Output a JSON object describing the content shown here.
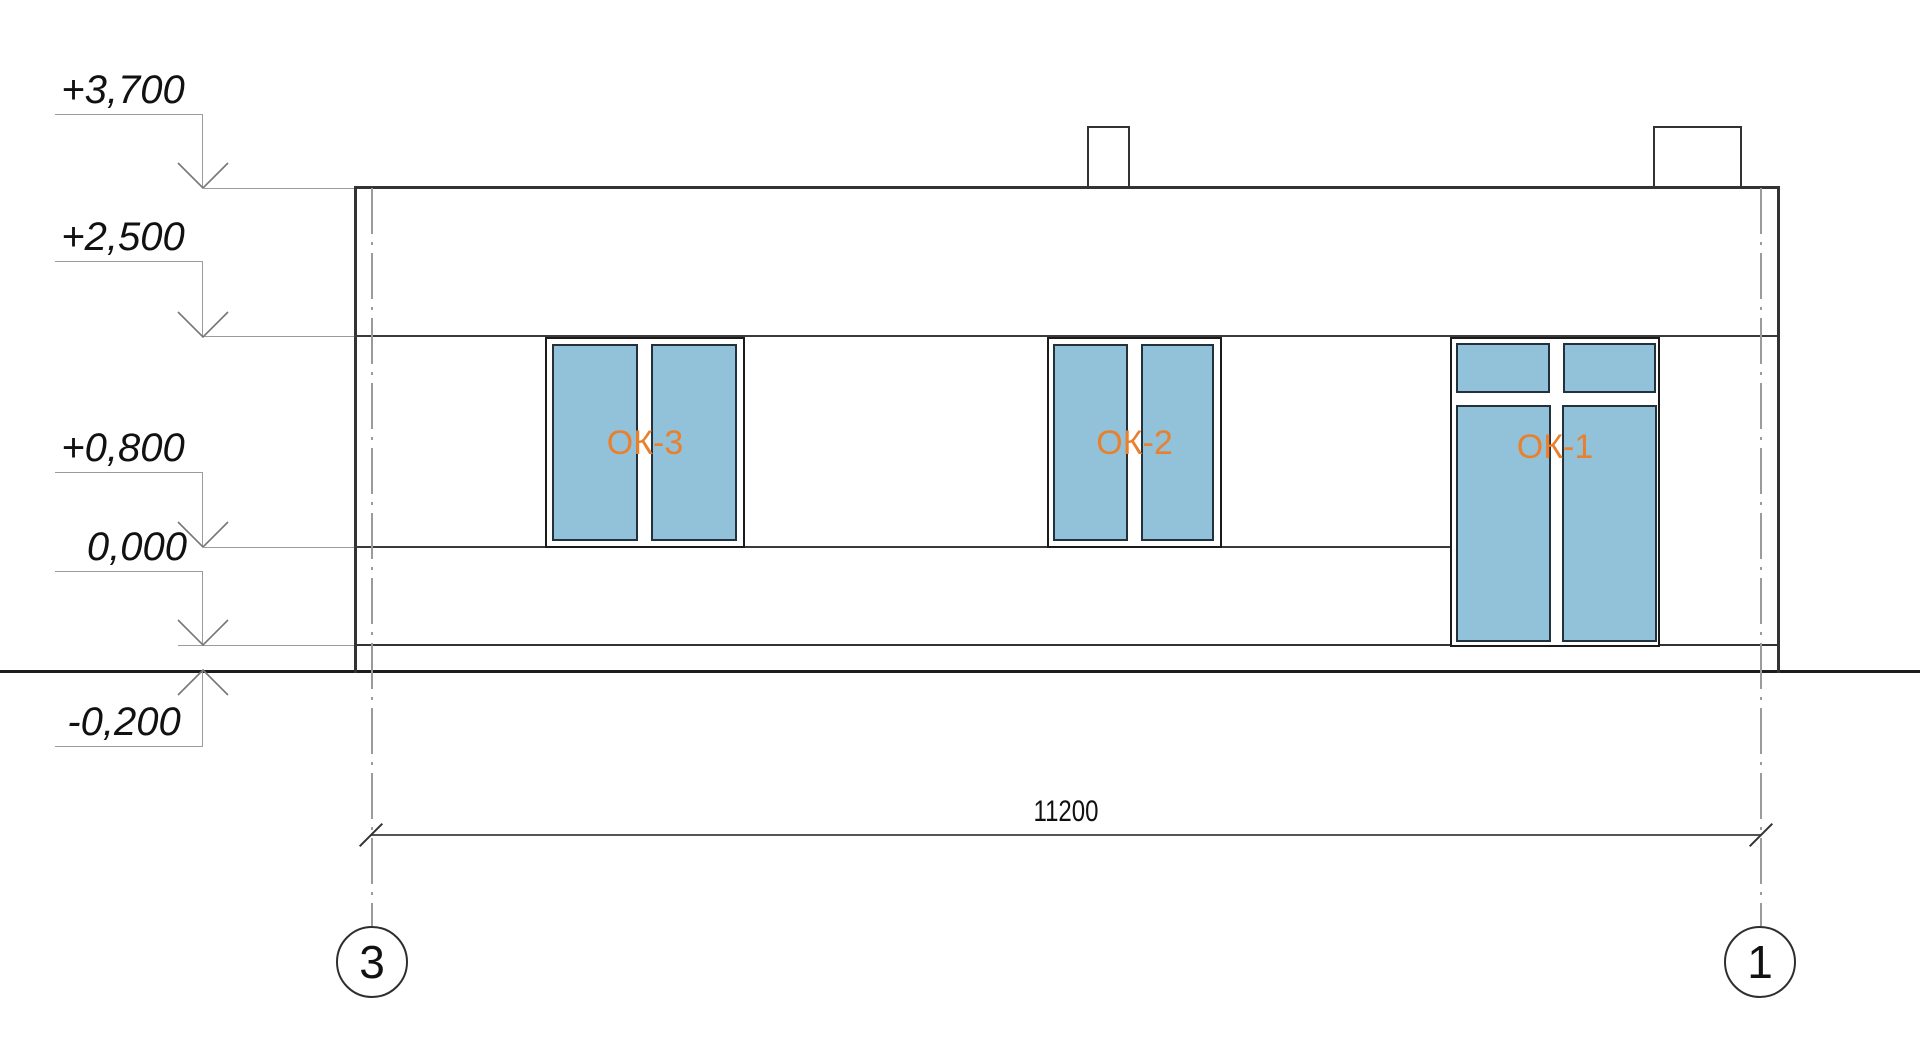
{
  "levels": [
    {
      "label": "+3,700"
    },
    {
      "label": "+2,500"
    },
    {
      "label": "+0,800"
    },
    {
      "label": "0,000"
    },
    {
      "label": "-0,200"
    }
  ],
  "windows": [
    {
      "label": "ОК-3"
    },
    {
      "label": "ОК-2"
    },
    {
      "label": "ОК-1"
    }
  ],
  "dimension": {
    "total": "11200"
  },
  "axes": [
    {
      "label": "3"
    },
    {
      "label": "1"
    }
  ],
  "colors": {
    "glass_fill": "#92c2d9",
    "window_label": "#e8802e",
    "line_dark": "#333333",
    "line_medium": "#555555",
    "line_light": "#9b9b9b",
    "ground": "#1c1c1c",
    "pane_border": "#22313c"
  }
}
